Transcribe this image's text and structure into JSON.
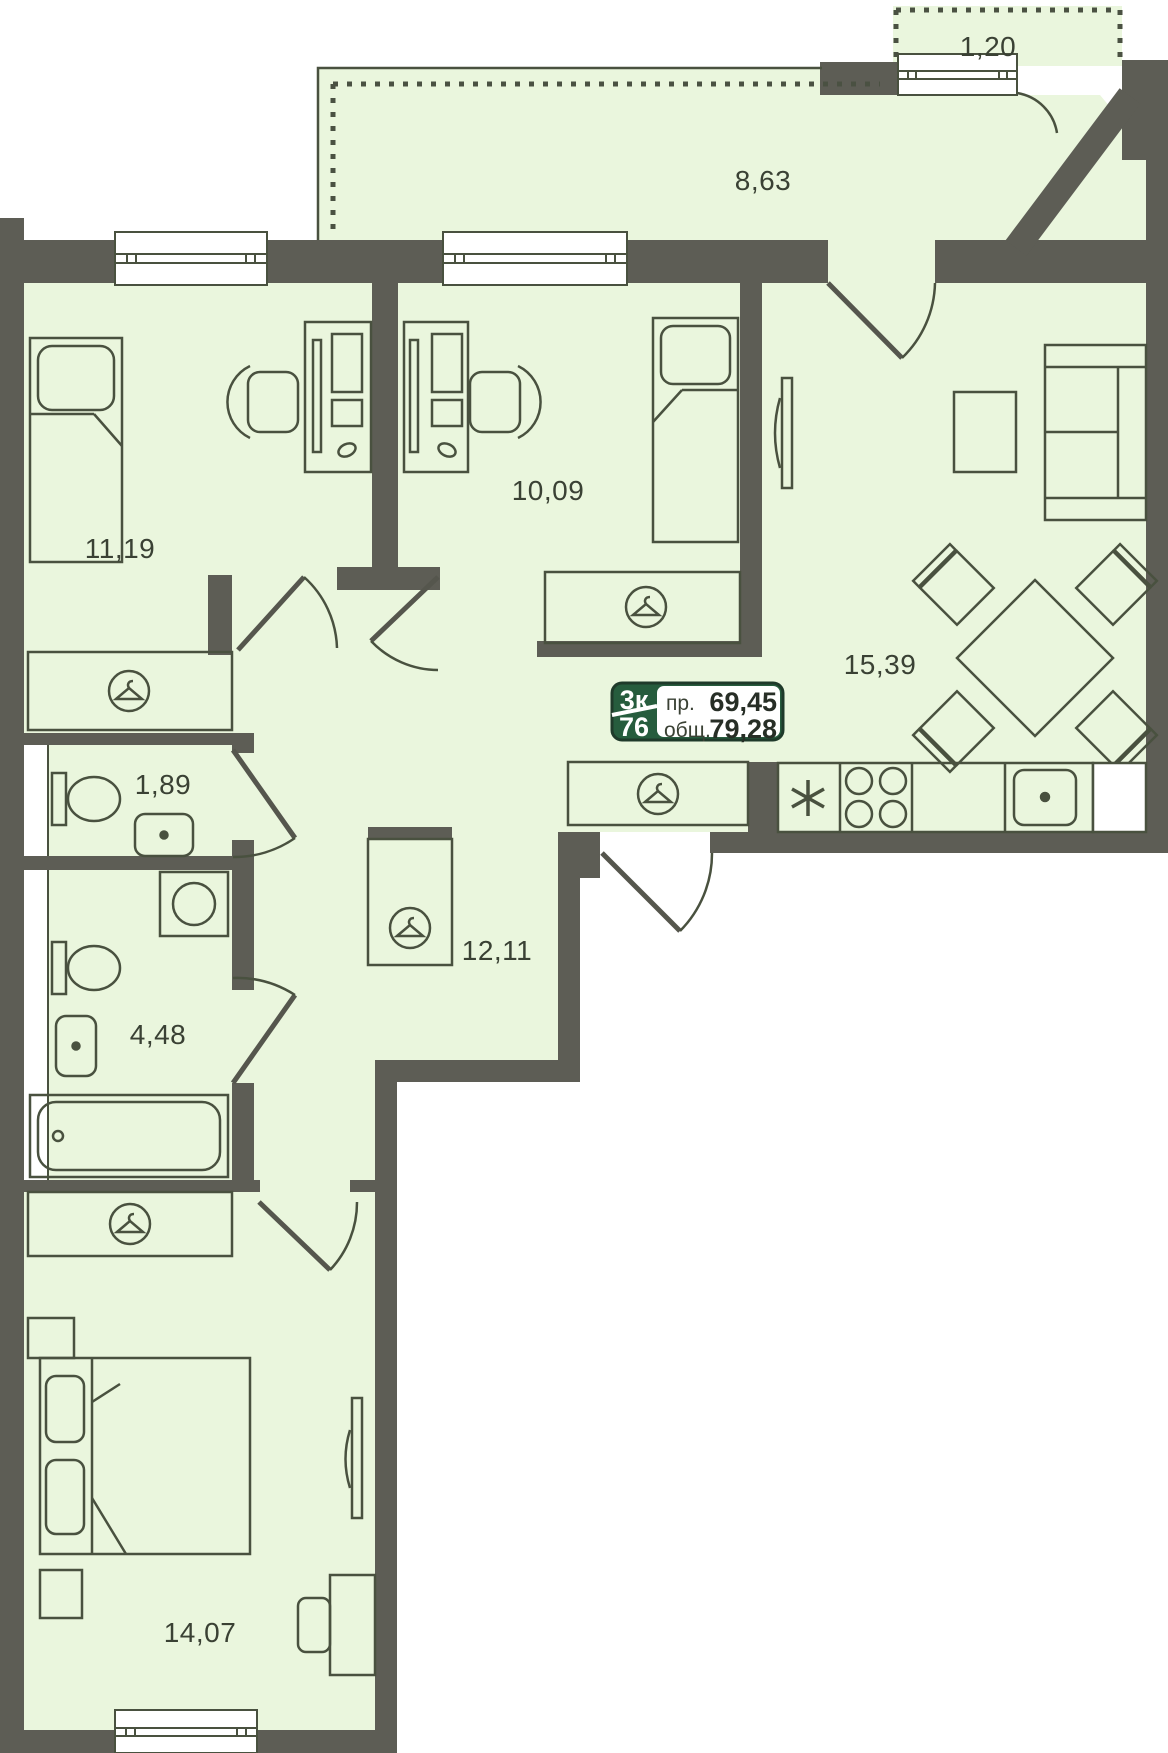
{
  "plan": {
    "badge": {
      "type": "3к",
      "number": "76",
      "living_label": "пр.",
      "living_value": "69,45",
      "total_label": "общ.",
      "total_value": "79,28"
    },
    "rooms": [
      {
        "name": "balcony",
        "area": "1,20"
      },
      {
        "name": "loggia",
        "area": "8,63"
      },
      {
        "name": "bedroom-left",
        "area": "11,19"
      },
      {
        "name": "bedroom-middle",
        "area": "10,09"
      },
      {
        "name": "living-room",
        "area": "15,39"
      },
      {
        "name": "wc",
        "area": "1,89"
      },
      {
        "name": "bathroom",
        "area": "4,48"
      },
      {
        "name": "hallway",
        "area": "12,11"
      },
      {
        "name": "bedroom-master",
        "area": "14,07"
      }
    ],
    "colors": {
      "wall": "#5d5d55",
      "floor": "#eaf6dd",
      "line": "#49513f",
      "badge_green": "#265c3d",
      "text": "#3a4134"
    },
    "icons": {
      "wardrobe": "hanger-icon",
      "fridge": "asterisk-icon",
      "stove": "burners-icon",
      "kitchen_sink": "basin-icon",
      "washer": "drum-icon"
    }
  }
}
